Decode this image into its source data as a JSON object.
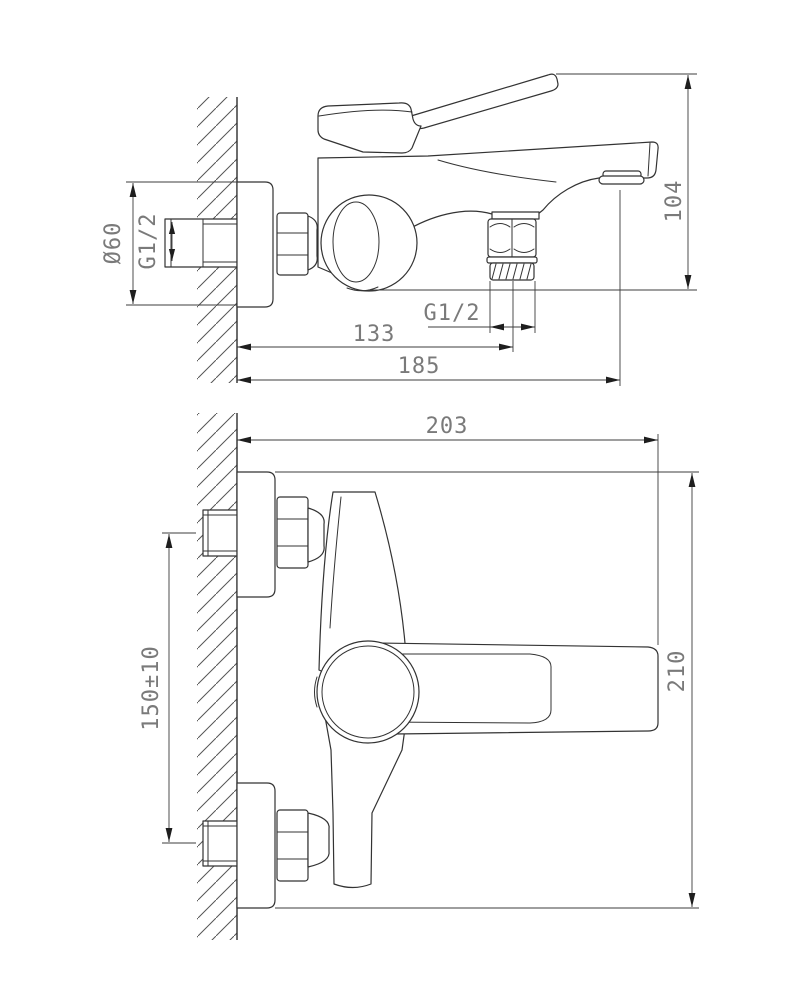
{
  "drawing": {
    "kind": "faucet installation dimensional drawing",
    "views": {
      "side": {
        "labels": {
          "flange_diameter": "Ø60",
          "wall_thread": "G1/2",
          "outlet_thread": "G1/2",
          "overall_height": "104",
          "wall_to_outlet": "133",
          "wall_to_spout_tip": "185"
        }
      },
      "front": {
        "labels": {
          "overall_width": "203",
          "inlet_spacing": "150±10",
          "overall_height": "210"
        }
      }
    }
  },
  "colors": {
    "background": "#ffffff",
    "line": "#333333",
    "dimension_text": "#7a7a7a",
    "hatch": "#555555"
  }
}
